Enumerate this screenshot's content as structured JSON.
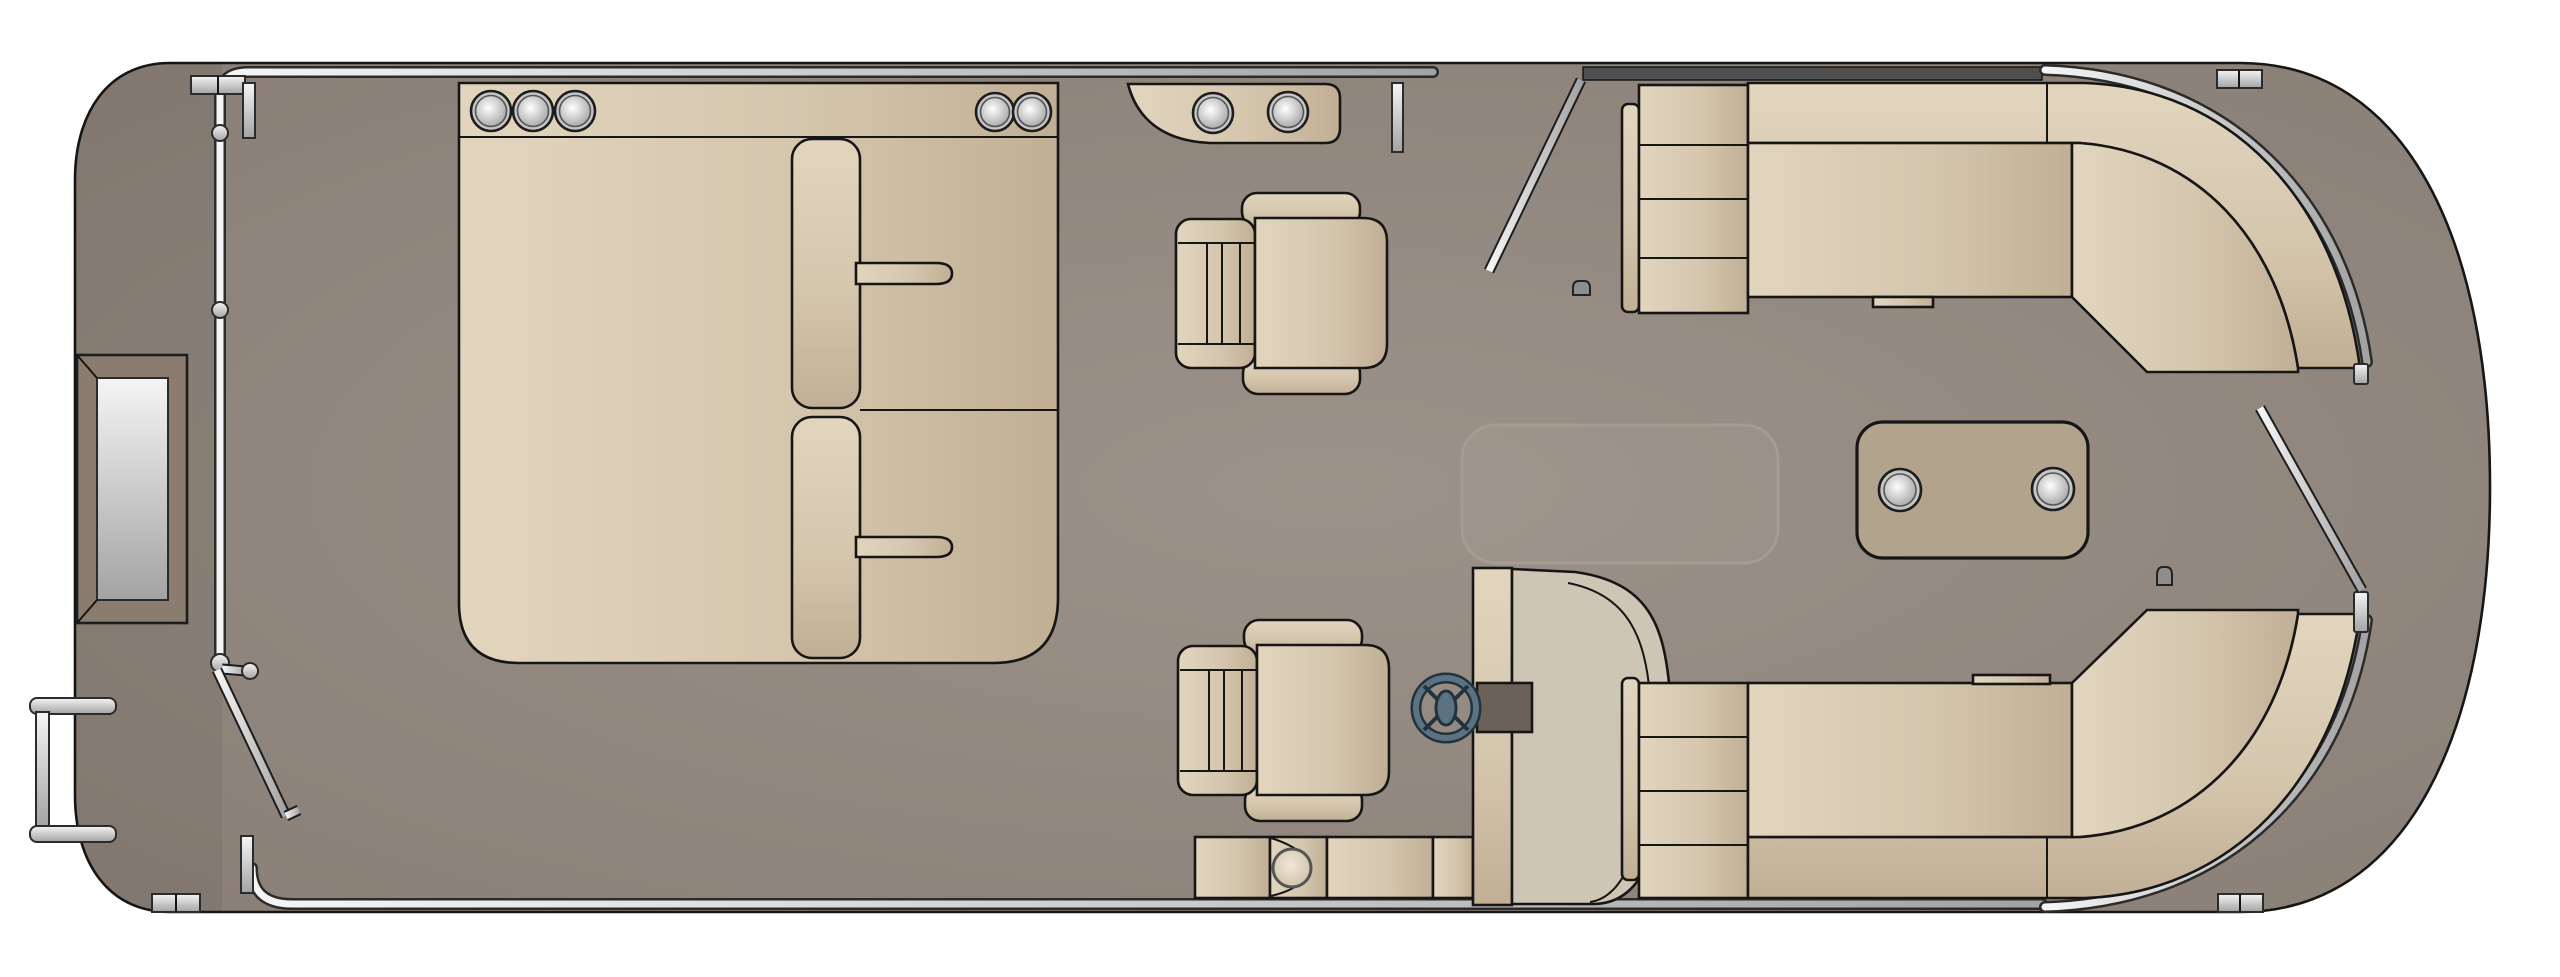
{
  "diagram": {
    "type": "boat-floor-plan",
    "subject": "pontoon-boat-top-down-layout",
    "orientation": "bow-left-stern-right",
    "visible_text": []
  },
  "palette": {
    "background": "#ffffff",
    "hull_center": "#9c9289",
    "hull_edge": "#897e75",
    "outline": "#161616",
    "seat_light": "#e2d5be",
    "seat_mid": "#d5c7ae",
    "seat_dark": "#c1af95",
    "pod_light": "#efe7d6",
    "pod_dark": "#cbbda4",
    "metal_light": "#f5f5f5",
    "metal_dark": "#a3a3a3",
    "knob_light": "#ffffff",
    "knob_dark": "#9e9e9e",
    "table_fill": "#b2a38d",
    "console_fill": "#cfc5b5",
    "wheel_rim": "#5a7282",
    "wheel_dark": "#22333d",
    "helm_mount": "#6b6159",
    "fence_dark": "#4f4f4f",
    "drain_fill": "#8d8d8d",
    "locker_outline": "#a59c93",
    "panel_frame": "#8a7c6e"
  },
  "parts": [
    {
      "name": "hull",
      "qty": 1
    },
    {
      "name": "bow-boarding-panel",
      "qty": 1
    },
    {
      "name": "boarding-ladder",
      "qty": 1
    },
    {
      "name": "mooring-cleat",
      "qty": 4
    },
    {
      "name": "bow-fence-rail",
      "qty": 1
    },
    {
      "name": "open-gate",
      "qty": 3
    },
    {
      "name": "gate-post",
      "qty": 5
    },
    {
      "name": "rail-ball-fitting",
      "qty": 4
    },
    {
      "name": "wraparound-bow-lounge",
      "qty": 1
    },
    {
      "name": "recessed-speaker",
      "qty": 5
    },
    {
      "name": "lounge-armrest-pad",
      "qty": 2
    },
    {
      "name": "captains-chair",
      "qty": 2
    },
    {
      "name": "bow-console-cup-holder-pod",
      "qty": 1
    },
    {
      "name": "cup-holder",
      "qty": 4
    },
    {
      "name": "helm-console",
      "qty": 1
    },
    {
      "name": "steering-wheel",
      "qty": 1
    },
    {
      "name": "jump-seat-bench",
      "qty": 1
    },
    {
      "name": "in-floor-storage-hatch",
      "qty": 1
    },
    {
      "name": "cocktail-table",
      "qty": 1
    },
    {
      "name": "stern-l-lounge",
      "qty": 2
    },
    {
      "name": "stern-perimeter-rail",
      "qty": 2
    },
    {
      "name": "deck-drain",
      "qty": 2
    }
  ]
}
